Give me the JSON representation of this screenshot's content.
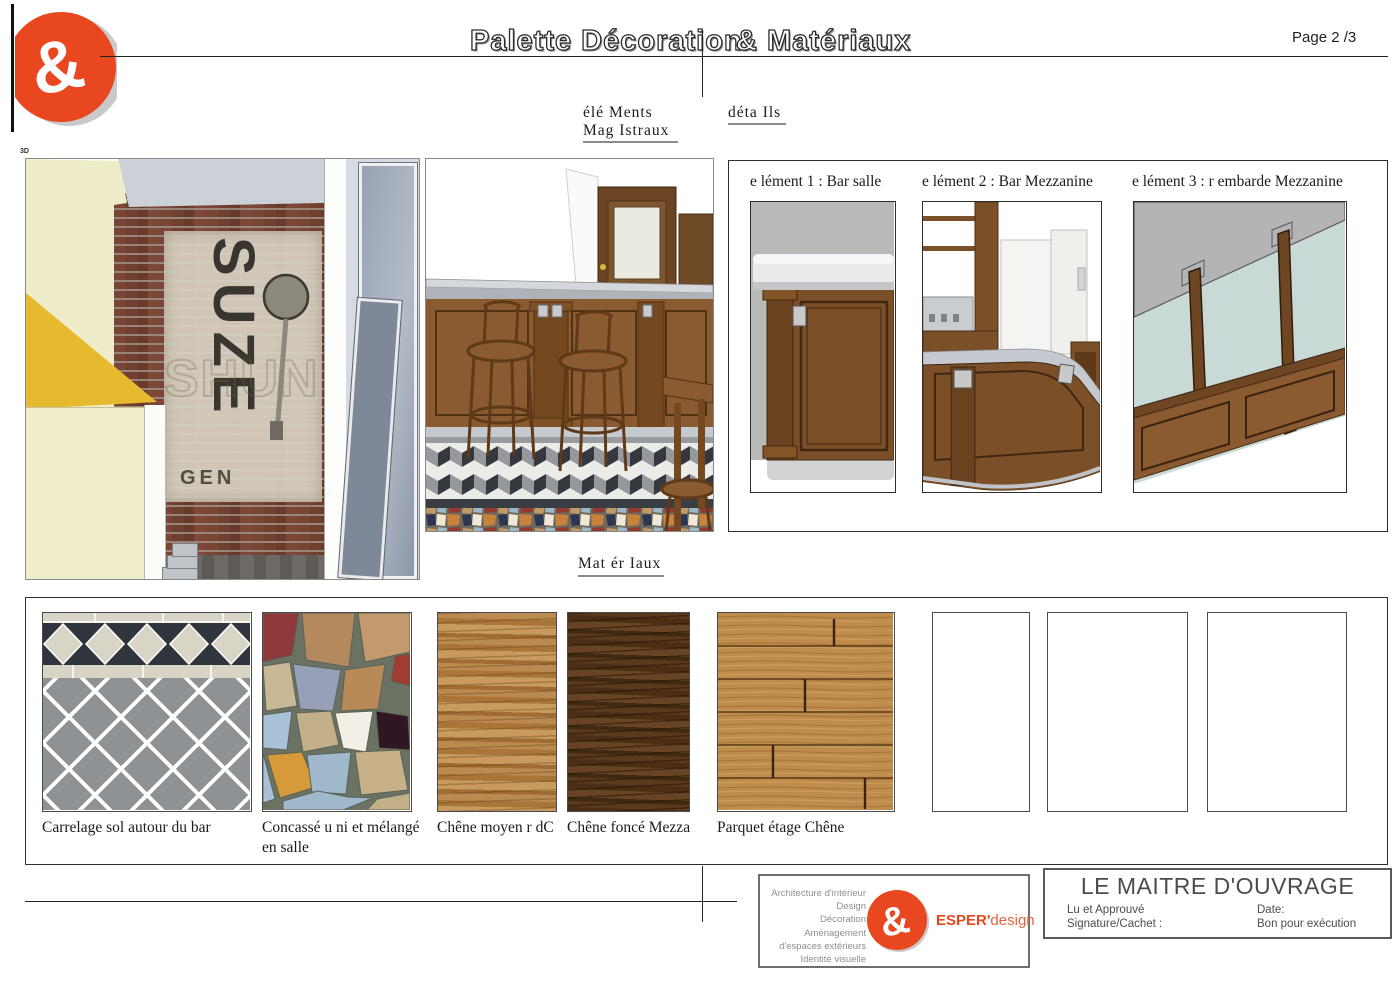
{
  "page": {
    "number_label": "Page 2  /3"
  },
  "header": {
    "title_left": "Palette Décoration",
    "title_right": "& Matériaux"
  },
  "labels": {
    "view3d": "3D",
    "elements_line1": "élé  Ments",
    "elements_line2": "Mag  Istraux",
    "details": "déta   Ils",
    "materials": "Mat  ér  Iaux"
  },
  "ghost_sign": {
    "vertical_text": "SUZE",
    "faint_text": "SHUN",
    "bottom_text": "GEN"
  },
  "elements_panel": {
    "items": [
      {
        "label": "e lément 1 : Bar salle"
      },
      {
        "label": "e lément 2 : Bar Mezzanine"
      },
      {
        "label": "e lément 3 : r embarde Mezzanine"
      }
    ]
  },
  "materials": {
    "swatches": [
      {
        "name": "carrelage",
        "caption": "Carrelage sol autour du bar"
      },
      {
        "name": "concasse",
        "caption": "Concassé u ni et mélangé en salle"
      },
      {
        "name": "chene-moyen",
        "caption": "Chêne moyen r  dC"
      },
      {
        "name": "chene-fonce",
        "caption": "Chêne foncé Mezza"
      },
      {
        "name": "parquet",
        "caption": "Parquet étage Chêne"
      },
      {
        "name": "empty-1",
        "caption": ""
      },
      {
        "name": "empty-2",
        "caption": ""
      },
      {
        "name": "empty-3",
        "caption": ""
      }
    ]
  },
  "footer": {
    "services": [
      "Architecture d'intérieur",
      "Design",
      "Décoration",
      "Aménagement",
      "d'espaces extérieurs",
      "Identité visuelle"
    ],
    "brand": {
      "ampersand": "&",
      "bold": "ESPER'",
      "light": "design"
    },
    "approval": {
      "title": "LE MAITRE D'OUVRAGE",
      "left_line1": "Lu et Approuvé",
      "left_line2": "Signature/Cachet :",
      "right_line1": "Date:",
      "right_line2": "Bon pour exécution"
    }
  },
  "colors": {
    "accent": "#e8471f",
    "accent_light": "#e8623c",
    "wood_medium": "#a9773d",
    "wood_dark": "#553517",
    "glass": "#c9d9d5",
    "tile_dark": "#30343d",
    "tile_gray": "#8f9295",
    "tile_cream": "#d8d4c6"
  }
}
